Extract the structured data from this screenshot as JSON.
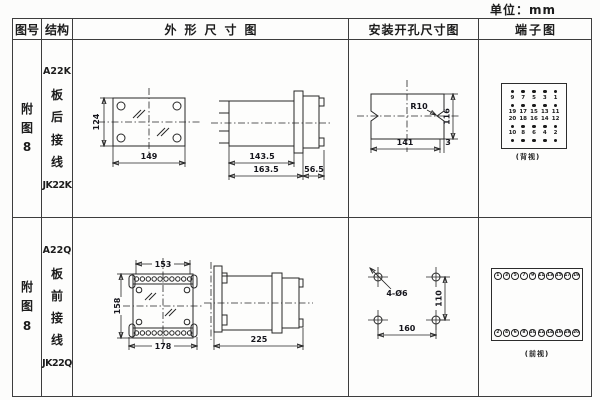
{
  "unit_label": "单位：mm",
  "header": {
    "fig_no": "图号",
    "structure": "结构",
    "outline": "外形尺寸图",
    "mounting": "安装开孔尺寸图",
    "terminal": "端子图"
  },
  "row1": {
    "fig_no": "附图8",
    "model": "A22K",
    "wiring": "板后接线",
    "code": "JK22K",
    "outline": {
      "front_height": "124",
      "front_width": "149",
      "body_depth": "143.5",
      "total_depth": "163.5",
      "rear_depth": "56.5"
    },
    "mounting": {
      "radius": "R10",
      "cutout_height": "116",
      "cutout_width": "141",
      "edge_offset": "3"
    },
    "terminal": {
      "caption": "(背视)",
      "row1": [
        "9",
        "7",
        "5",
        "3",
        "1"
      ],
      "row2": [
        "19",
        "17",
        "15",
        "13",
        "11"
      ],
      "row3": [
        "20",
        "18",
        "16",
        "14",
        "12"
      ],
      "row4": [
        "10",
        "8",
        "6",
        "4",
        "2"
      ]
    }
  },
  "row2": {
    "fig_no": "附图8",
    "model": "A22Q",
    "wiring": "板前接线",
    "code": "JK22Q",
    "outline": {
      "top_width": "153",
      "front_height": "158",
      "front_width": "178",
      "total_depth": "225"
    },
    "mounting": {
      "holes": "4-Ø6",
      "hole_spacing_v": "110",
      "hole_spacing_h": "160"
    },
    "terminal": {
      "caption": "(前视)",
      "top": [
        "1",
        "3",
        "5",
        "7",
        "9",
        "11",
        "13",
        "15",
        "17",
        "19"
      ],
      "bottom": [
        "2",
        "4",
        "6",
        "8",
        "10",
        "12",
        "14",
        "16",
        "18",
        "20"
      ]
    }
  }
}
